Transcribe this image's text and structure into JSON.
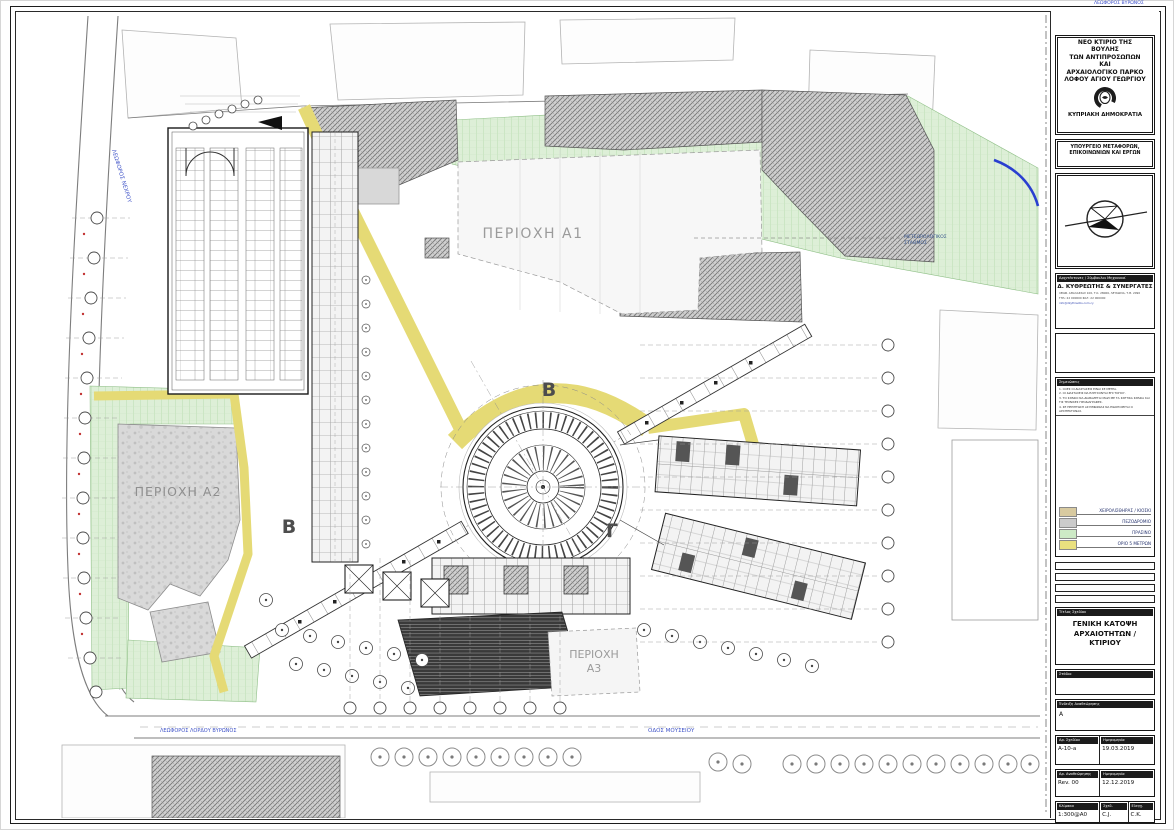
{
  "title_block": {
    "project_title_lines": [
      "ΝΕΟ ΚΤΙΡΙΟ ΤΗΣ",
      "ΒΟΥΛΗΣ",
      "ΤΩΝ ΑΝΤΙΠΡΟΣΩΠΩΝ",
      "ΚΑΙ",
      "ΑΡΧΑΙΟΛΟΓΙΚΟ ΠΑΡΚΟ",
      "ΛΟΦΟΥ ΑΓΙΟΥ ΓΕΩΡΓΙΟΥ"
    ],
    "coat_of_arms_icon": "cyprus-coat-of-arms",
    "state": "ΚΥΠΡΙΑΚΗ ΔΗΜΟΚΡΑΤΙΑ",
    "ministry_lines": [
      "ΥΠΟΥΡΓΕΙΟ ΜΕΤΑΦΟΡΩΝ,",
      "ΕΠΙΚΟΙΝΩΝΙΩΝ ΚΑΙ ΕΡΓΩΝ"
    ],
    "north_arrow_icon": "north-arrow-compass",
    "architect": {
      "header": "Αρχιτέκτονες / Σύμβουλοι Μηχανικοί",
      "name": "Δ. ΚΥΘΡΕΩΤΗΣ & ΣΥΝΕΡΓΑΤΕΣ",
      "address_line1": "ΛΕΩΦ. ΑΘΑΛΑΣΣΑΣ 100, Τ.Κ. 28066, ΛΕΥΚΩΣΙΑ, Τ.Θ. 2090",
      "address_line2": "ΤΗΛ: 22 000000    ΦΑΞ: 22 000000",
      "address_line3": "info@dkythreotis.com.cy"
    },
    "notes": {
      "header": "Σημειώσεις",
      "items": [
        "1.  ΟΛΕΣ ΟΙ ΔΙΑΣΤΑΣΕΙΣ ΕΙΝΑΙ ΣΕ ΜΕΤΡΑ.",
        "2.  ΟΙ ΔΙΑΣΤΑΣΕΙΣ ΝΑ ΕΛΕΓΧΟΝΤΑΙ ΕΠΙ ΤΟΠΟΥ.",
        "3.  ΤΟ ΣΧΕΔΙΟ ΝΑ ΔΙΑΒΑΖΕΤΑΙ ΜΑΖΙ ΜΕ ΤΑ ΣΧΕΤΙΚΑ ΣΧΕΔΙΑ ΚΑΙ ΤΙΣ ΤΕΧΝΙΚΕΣ ΠΡΟΔΙΑΓΡΑΦΕΣ.",
        "4.  ΣΕ ΠΕΡΙΠΤΩΣΗ ΑΣΥΜΦΩΝΙΑΣ ΝΑ ΕΙΔΟΠΟΙΕΙΤΑΙ Ο ΑΡΧΙΤΕΚΤΟΝΑΣ."
      ]
    },
    "legend": {
      "items": [
        {
          "label": "ΧΕΙΡΟΛΙΣΘΗΡΑΣ / ΚΙΟΣΚΙ",
          "color": "#d8caa0"
        },
        {
          "label": "ΠΕΖΟΔΡΟΜΙΟ",
          "color": "#cbcbcb"
        },
        {
          "label": "ΠΡΑΣΙΝΟ",
          "color": "#cdeac6"
        },
        {
          "label": "ΟΡΙΟ 5 ΜΕΤΡΩΝ",
          "color": "#e9e07f"
        }
      ]
    },
    "drawing_title": {
      "header": "Τίτλος Σχεδίου",
      "lines": [
        "ΓΕΝΙΚΗ ΚΑΤΟΨΗ",
        "ΑΡΧΑΙΟΤΗΤΩΝ /",
        "ΚΤΙΡΙΟΥ"
      ]
    },
    "stage": {
      "header": "Στάδιο"
    },
    "revision_index": {
      "header": "Ένδειξη Αναθεώρησης",
      "value": "A"
    },
    "drawing_no": {
      "header": "Αρ. Σχεδίου",
      "value": "A-10-a"
    },
    "drawing_date": {
      "header": "Ημερομηνία",
      "value": "19.03.2019"
    },
    "revision": {
      "header": "Αρ. Αναθεώρησης",
      "value": "Rev. 00"
    },
    "revision_date": {
      "header": "Ημερομηνία",
      "value": "12.12.2019"
    },
    "scale": {
      "header": "Κλίμακα",
      "value": "1:300@A0"
    },
    "drawn_by": {
      "header": "Σχεδ.",
      "value": "C.J."
    },
    "checked_by": {
      "header": "Ελεγχ.",
      "value": "C.K."
    }
  },
  "plan": {
    "labels": {
      "area_a1": "ΠΕΡΙΟΧΗ A1",
      "area_a2": "ΠΕΡΙΟΧΗ A2",
      "area_a3_line1": "ΠΕΡΙΟΧΗ",
      "area_a3_line2": "Α3",
      "section_marker_b_top": "B",
      "section_marker_b_left": "B",
      "section_marker_gamma": "Γ",
      "met_station_line1": "ΜΕΤΕΩΡΟΛΟΓΙΚΟΣ",
      "met_station_line2": "ΣΤΑΘΜΟΣ",
      "street_left": "ΛΕΩΦΟΡΟΣ ΝΕΧΡΟΥ",
      "street_bottom_left": "ΛΕΩΦΟΡΟΣ ΛΟΡΔΟΥ ΒΥΡΩΝΟΣ",
      "street_bottom": "ΟΔΟΣ ΜΟΥΣΕΙΟΥ",
      "top_edge_text": "ΛΕΩΦΟΡΟΣ ΒΥΡΩΝΟΣ"
    },
    "legend_colors": {
      "kiosk": "#d8caa0",
      "sidewalk": "#cbcbcb",
      "green": "#cdeac6",
      "limit_5m": "#e9e07f"
    }
  }
}
